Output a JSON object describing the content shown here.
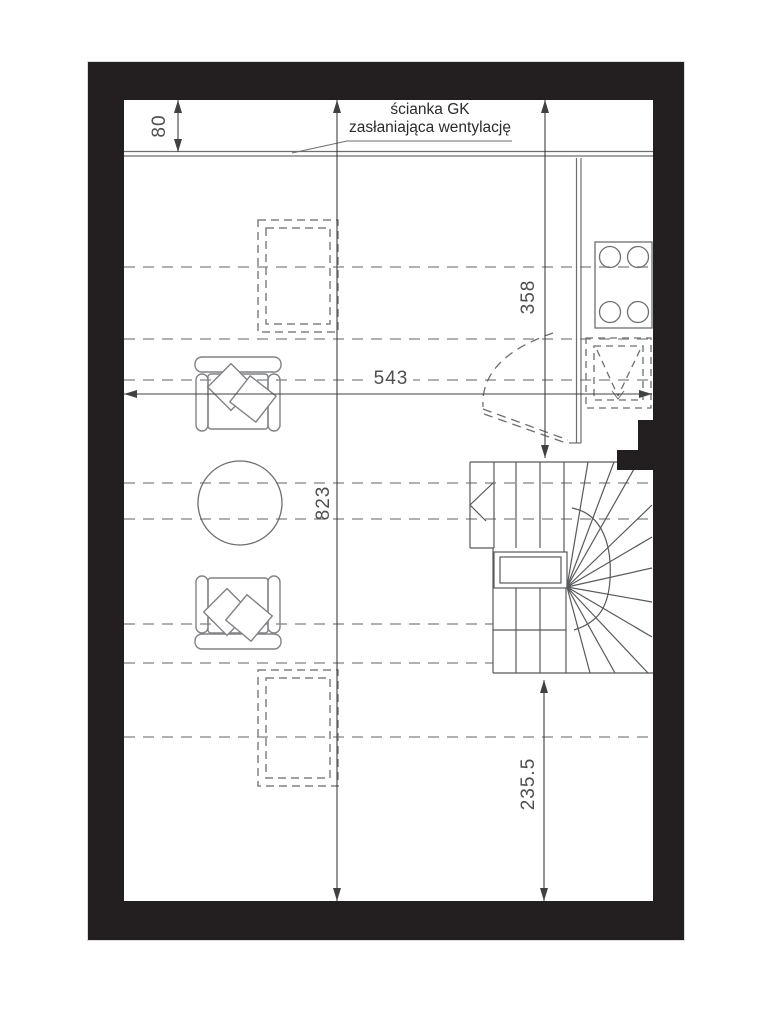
{
  "note": {
    "line1": "ścianka GK",
    "line2": "zasłaniająca wentylację"
  },
  "dimensions": {
    "partition_offset": "80",
    "kitchen_side": "358",
    "room_width": "543",
    "room_length": "823",
    "below_stairs": "235.5"
  },
  "colors": {
    "wall_black": "#231f20",
    "thin_line_gray": "#6d6e71",
    "dashed_gray": "#939598",
    "dimension_gray": "#414042"
  }
}
